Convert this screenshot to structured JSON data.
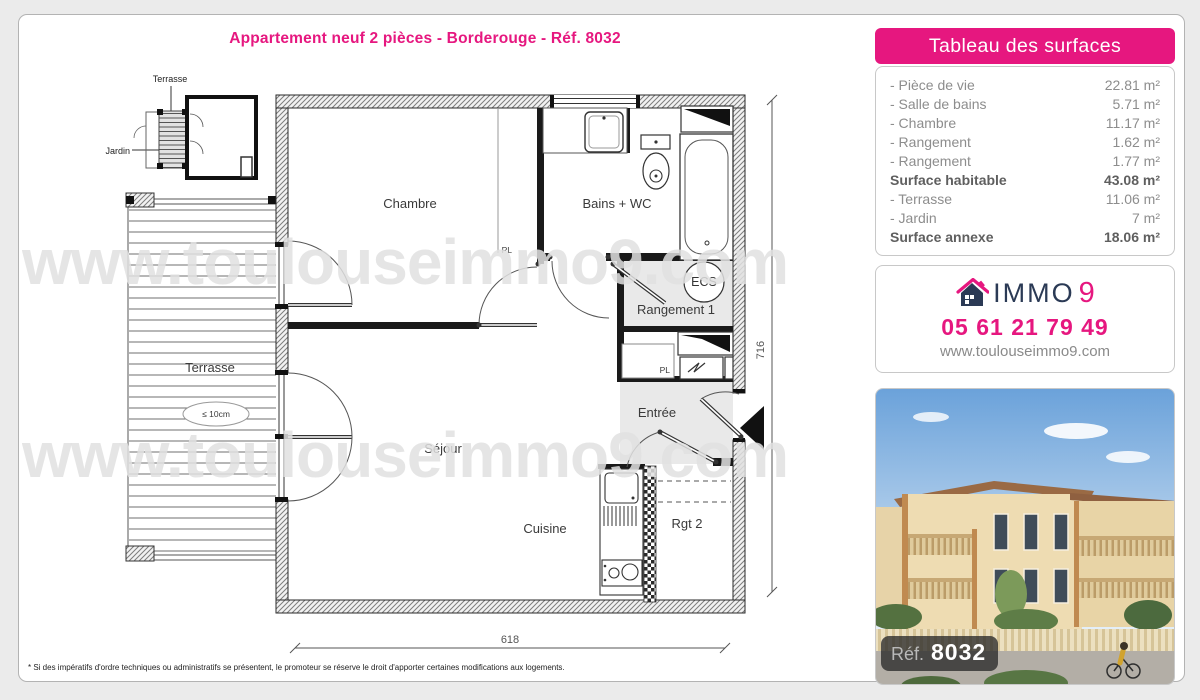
{
  "page": {
    "title": "Appartement neuf 2 pièces - Borderouge - Réf. 8032"
  },
  "watermark": {
    "text": "www.toulouseimmo9.com"
  },
  "plan": {
    "labels": {
      "chambre": "Chambre",
      "bains": "Bains + WC",
      "sejour": "Séjour",
      "cuisine": "Cuisine",
      "entree": "Entrée",
      "rangement1": "Rangement 1",
      "rgt2": "Rgt 2",
      "terrasse": "Terrasse",
      "pl1": "PL",
      "pl2": "PL",
      "ecs": "ECS",
      "terrace_note": "≤ 10cm"
    },
    "minimap": {
      "terrasse": "Terrasse",
      "jardin": "Jardin"
    },
    "dimensions": {
      "width_cm": "618",
      "height_cm": "716"
    }
  },
  "surfaces": {
    "header": "Tableau des surfaces",
    "rows": [
      {
        "label": "- Pièce de vie",
        "value": "22.81 m²"
      },
      {
        "label": "- Salle de bains",
        "value": "5.71 m²"
      },
      {
        "label": "- Chambre",
        "value": "11.17 m²"
      },
      {
        "label": "- Rangement",
        "value": "1.62 m²"
      },
      {
        "label": "- Rangement",
        "value": "1.77 m²"
      },
      {
        "label": "Surface habitable",
        "value": "43.08 m²"
      },
      {
        "label": "- Terrasse",
        "value": "11.06 m²"
      },
      {
        "label": "- Jardin",
        "value": "7 m²"
      },
      {
        "label": "Surface annexe",
        "value": "18.06 m²"
      }
    ]
  },
  "agency": {
    "brand_immo": "IMMO",
    "brand_9": "9",
    "phone": "05 61 21 79 49",
    "website": "www.toulouseimmo9.com"
  },
  "photo": {
    "ref_label": "Réf.",
    "ref_value": "8032"
  },
  "footnote": "* Si des impératifs d'ordre techniques ou administratifs se présentent, le promoteur se réserve le droit d'apporter certaines modifications aux logements.",
  "colors": {
    "accent_pink": "#e6177f",
    "brand_navy": "#2b3a55"
  }
}
